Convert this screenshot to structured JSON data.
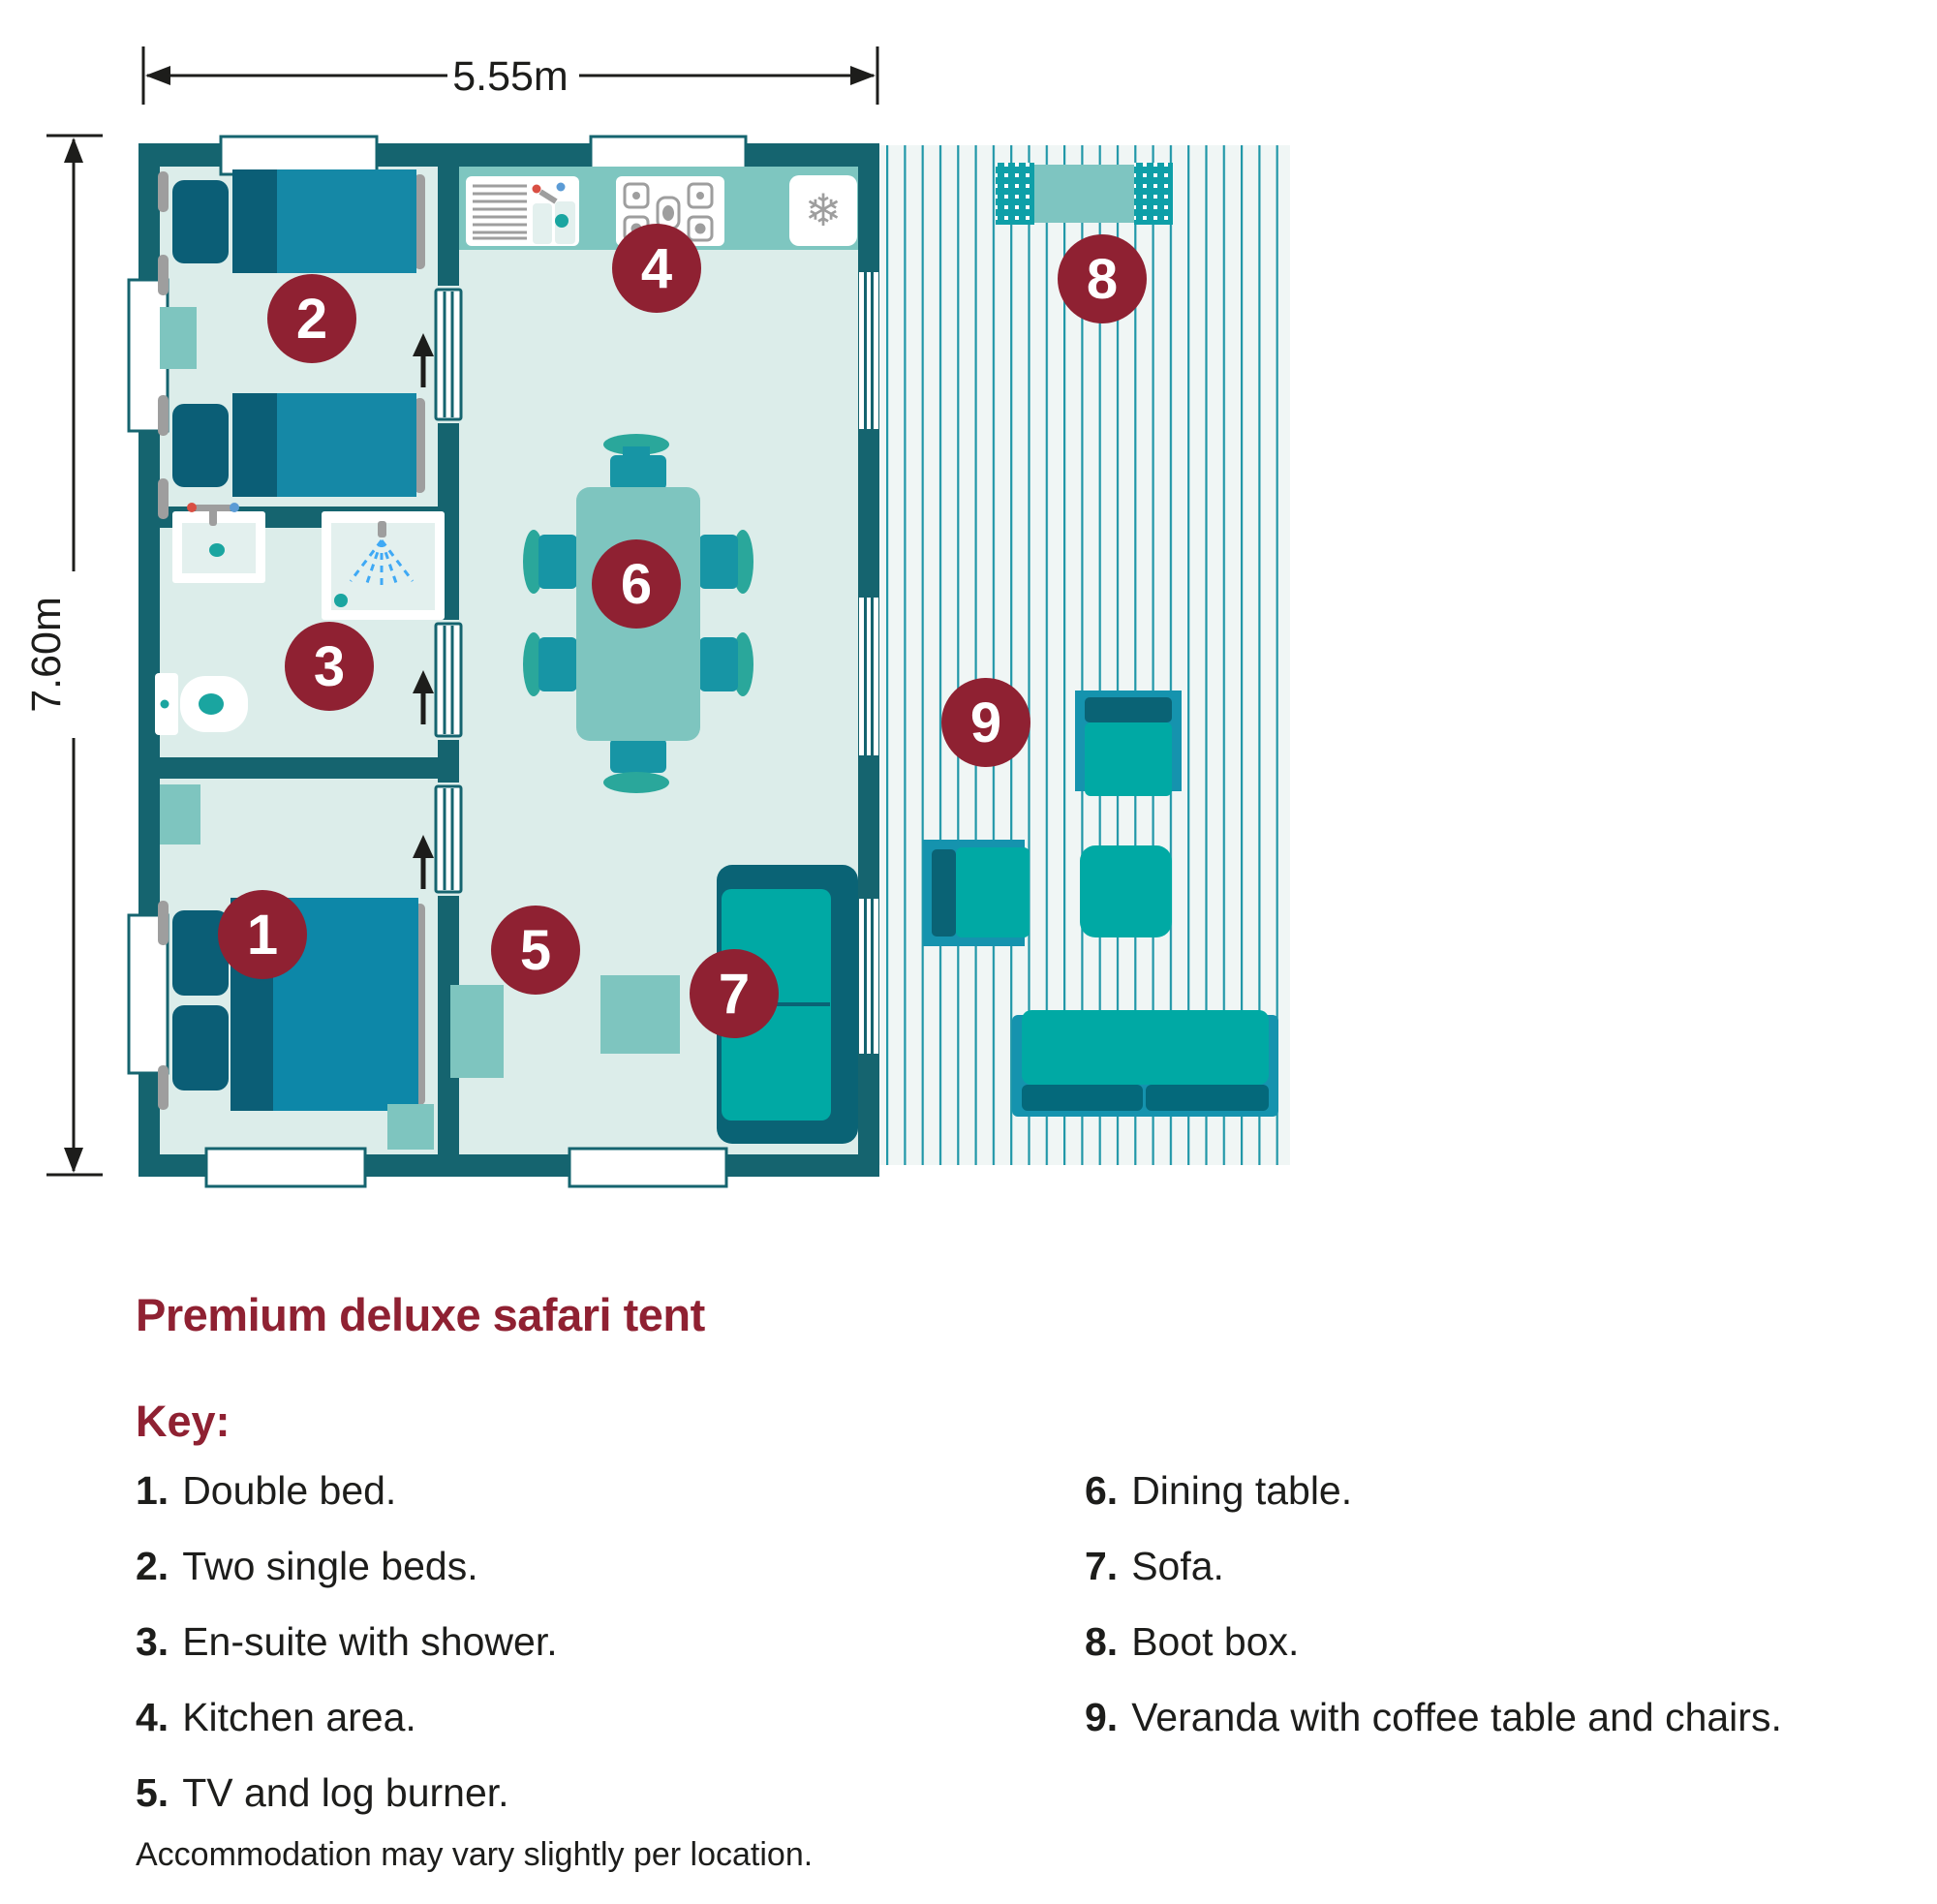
{
  "header": {
    "title": "Premium deluxe safari tent"
  },
  "plan": {
    "dimensions": {
      "width_label": "5.55m",
      "height_label": "7.60m"
    },
    "badges": [
      {
        "num": "1",
        "label": "Double bed"
      },
      {
        "num": "2",
        "label": "Two single beds"
      },
      {
        "num": "3",
        "label": "En-suite with shower"
      },
      {
        "num": "4",
        "label": "Kitchen area"
      },
      {
        "num": "5",
        "label": "TV and log burner"
      },
      {
        "num": "6",
        "label": "Dining table"
      },
      {
        "num": "7",
        "label": "Sofa"
      },
      {
        "num": "8",
        "label": "Boot box"
      },
      {
        "num": "9",
        "label": "Veranda with coffee table and chairs"
      }
    ],
    "icons": {
      "snowflake": "❄"
    }
  },
  "key": {
    "heading": "Key:",
    "items_left": [
      {
        "num": "1.",
        "text": "Double bed."
      },
      {
        "num": "2.",
        "text": "Two single beds."
      },
      {
        "num": "3.",
        "text": "En-suite with shower."
      },
      {
        "num": "4.",
        "text": "Kitchen area."
      },
      {
        "num": "5.",
        "text": "TV and log burner."
      }
    ],
    "items_right": [
      {
        "num": "6.",
        "text": "Dining table."
      },
      {
        "num": "7.",
        "text": "Sofa."
      },
      {
        "num": "8.",
        "text": "Boot box."
      },
      {
        "num": "9.",
        "text": "Veranda with coffee table and chairs."
      }
    ]
  },
  "footer": {
    "note": "Accommodation may vary slightly per location."
  },
  "colors": {
    "brand_maroon": "#8F2132",
    "wall_teal": "#15646F",
    "furniture_teal": "#00A9A4",
    "furniture_dark_teal": "#0A6375",
    "frame_cyan": "#1593AE",
    "counter_teal": "#7EC6C0",
    "light_teal": "#7EC5BF",
    "bed_blue": "#1588A6",
    "bed_dark": "#0B5E76",
    "floor_mint": "#DCEDEA",
    "veranda_bg": "#F0F6F5",
    "deck_line": "#2097A8",
    "text_dark": "#1D1D1B",
    "gray": "#9E9E9E"
  }
}
